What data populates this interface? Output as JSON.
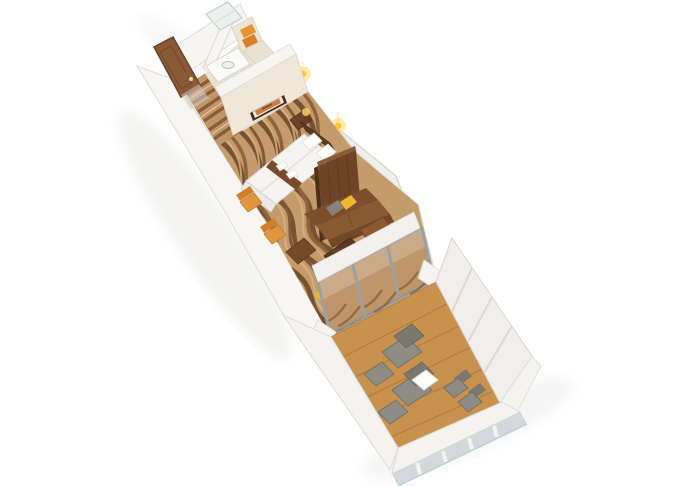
{
  "scene": {
    "title": "3D cutaway floor plan render — suite stateroom with private balcony",
    "render_style": "isometric-perspective-3d-floorplan",
    "background_color": "#ffffff",
    "rooms": [
      {
        "id": "entry-hall",
        "label": "Entry hallway",
        "items": [
          "entry-door",
          "striped-runner-carpet",
          "wardrobe",
          "accent-panel"
        ]
      },
      {
        "id": "bathroom",
        "label": "Bathroom",
        "items": [
          "shower-stall",
          "vanity-counter",
          "washbasin",
          "toilet",
          "towel-shelf",
          "orange-towel-stacks"
        ]
      },
      {
        "id": "bedroom",
        "label": "Bedroom",
        "items": [
          "double-bed",
          "white-pillows",
          "bed-runner",
          "rolled-towels",
          "headboard",
          "nightstand",
          "table-lamp",
          "wall-sconces",
          "framed-artwork",
          "orange-side-chairs",
          "dresser"
        ]
      },
      {
        "id": "living-room",
        "label": "Living room",
        "items": [
          "wood-room-divider",
          "l-shaped-sofa",
          "throw-pillows",
          "slatted-coffee-table",
          "media-console",
          "yellow-floor-cushions",
          "wave-pattern-carpet"
        ]
      },
      {
        "id": "balcony",
        "label": "Private balcony",
        "items": [
          "sliding-glass-wall",
          "teak-deck",
          "sun-loungers",
          "footstools",
          "white-side-table",
          "deck-chairs",
          "glass-front-railing",
          "ribbed-privacy-wall"
        ]
      }
    ],
    "counts": {
      "glass_wall_panels": 3,
      "sun_loungers": 2,
      "deck_chairs": 2,
      "orange_chairs": 2,
      "towel_stacks": 2,
      "accent_pillows": 4,
      "wall_sconces": 2
    },
    "colors": {
      "background": "#ffffff",
      "wall_white": "#f6f5f2",
      "wall_bright": "#f7f6f3",
      "wall_shade": "#f0efeb",
      "wall_cream": "#efe8da",
      "wall_cream2": "#ece4d4",
      "bathroom_floor": "#e9e1d1",
      "hall_carpet": "#c09668",
      "hall_stripe": "#8a5c38",
      "carpet_base": "#c49b6b",
      "wave_dark": "#6d482b",
      "wave_mid": "#8a5c36",
      "wave_alt": "#7a4f2e",
      "wave_light": "#d9ba8c",
      "door_wood": "#8a5a36",
      "headboard": "#5d3a23",
      "nightstand": "#6b4227",
      "bed_white": "#f5f4f1",
      "pillow_white": "#fcfcfb",
      "runner": "#7a4a2c",
      "bench": "#eceae6",
      "chair_orange": "#e2953f",
      "chair_orange_dark": "#d07f2c",
      "dresser": "#754a28",
      "partition": "#6e4526",
      "partition_edge": "#4e3018",
      "partition_top": "#8a5c38",
      "sofa": "#8a5a33",
      "sofa_back": "#7c4e2b",
      "sofa_skirt": "#734727",
      "pillow_gray": "#84837c",
      "pillow_gray2": "#8a8982",
      "pillow_yellow": "#eeb832",
      "pillow_yellow2": "#e8b02c",
      "cushion_yellow": "#ecb832",
      "cushion_yellow2": "#e0a626",
      "coffee_table": "#5a3a22",
      "towel_orange": "#e8922e",
      "towel_orange2": "#d97f26",
      "mustard_accent": "#d9b23c",
      "glass_seethrough": "#bf956a",
      "glass_frame": "#8f9698",
      "fascia": "#f3f1ed",
      "deck_wood": "#c8914d",
      "deck_plank": "#aa7a40",
      "deck_threshold": "#6b4a2e",
      "lounger_gray": "#8d8d85",
      "lounger_back": "#79796f",
      "deck_chair_gray": "#8c8c84",
      "deck_table_white": "#fbfbfa",
      "railing_white": "#f4f3f0",
      "railing_glass": "#cdd6d9",
      "fixture_white": "#fafaf8",
      "shower_glass": "#eef0f0",
      "wardrobe_white": "#f1eee7",
      "glow_yellow": "#ffd75e",
      "glow_deep": "#ffbe2e",
      "art_orange": "#cf7a3e",
      "frame_dark": "#4a2f1c",
      "art_mat": "#f2ede2",
      "shadow": "#b9b5ae"
    }
  }
}
